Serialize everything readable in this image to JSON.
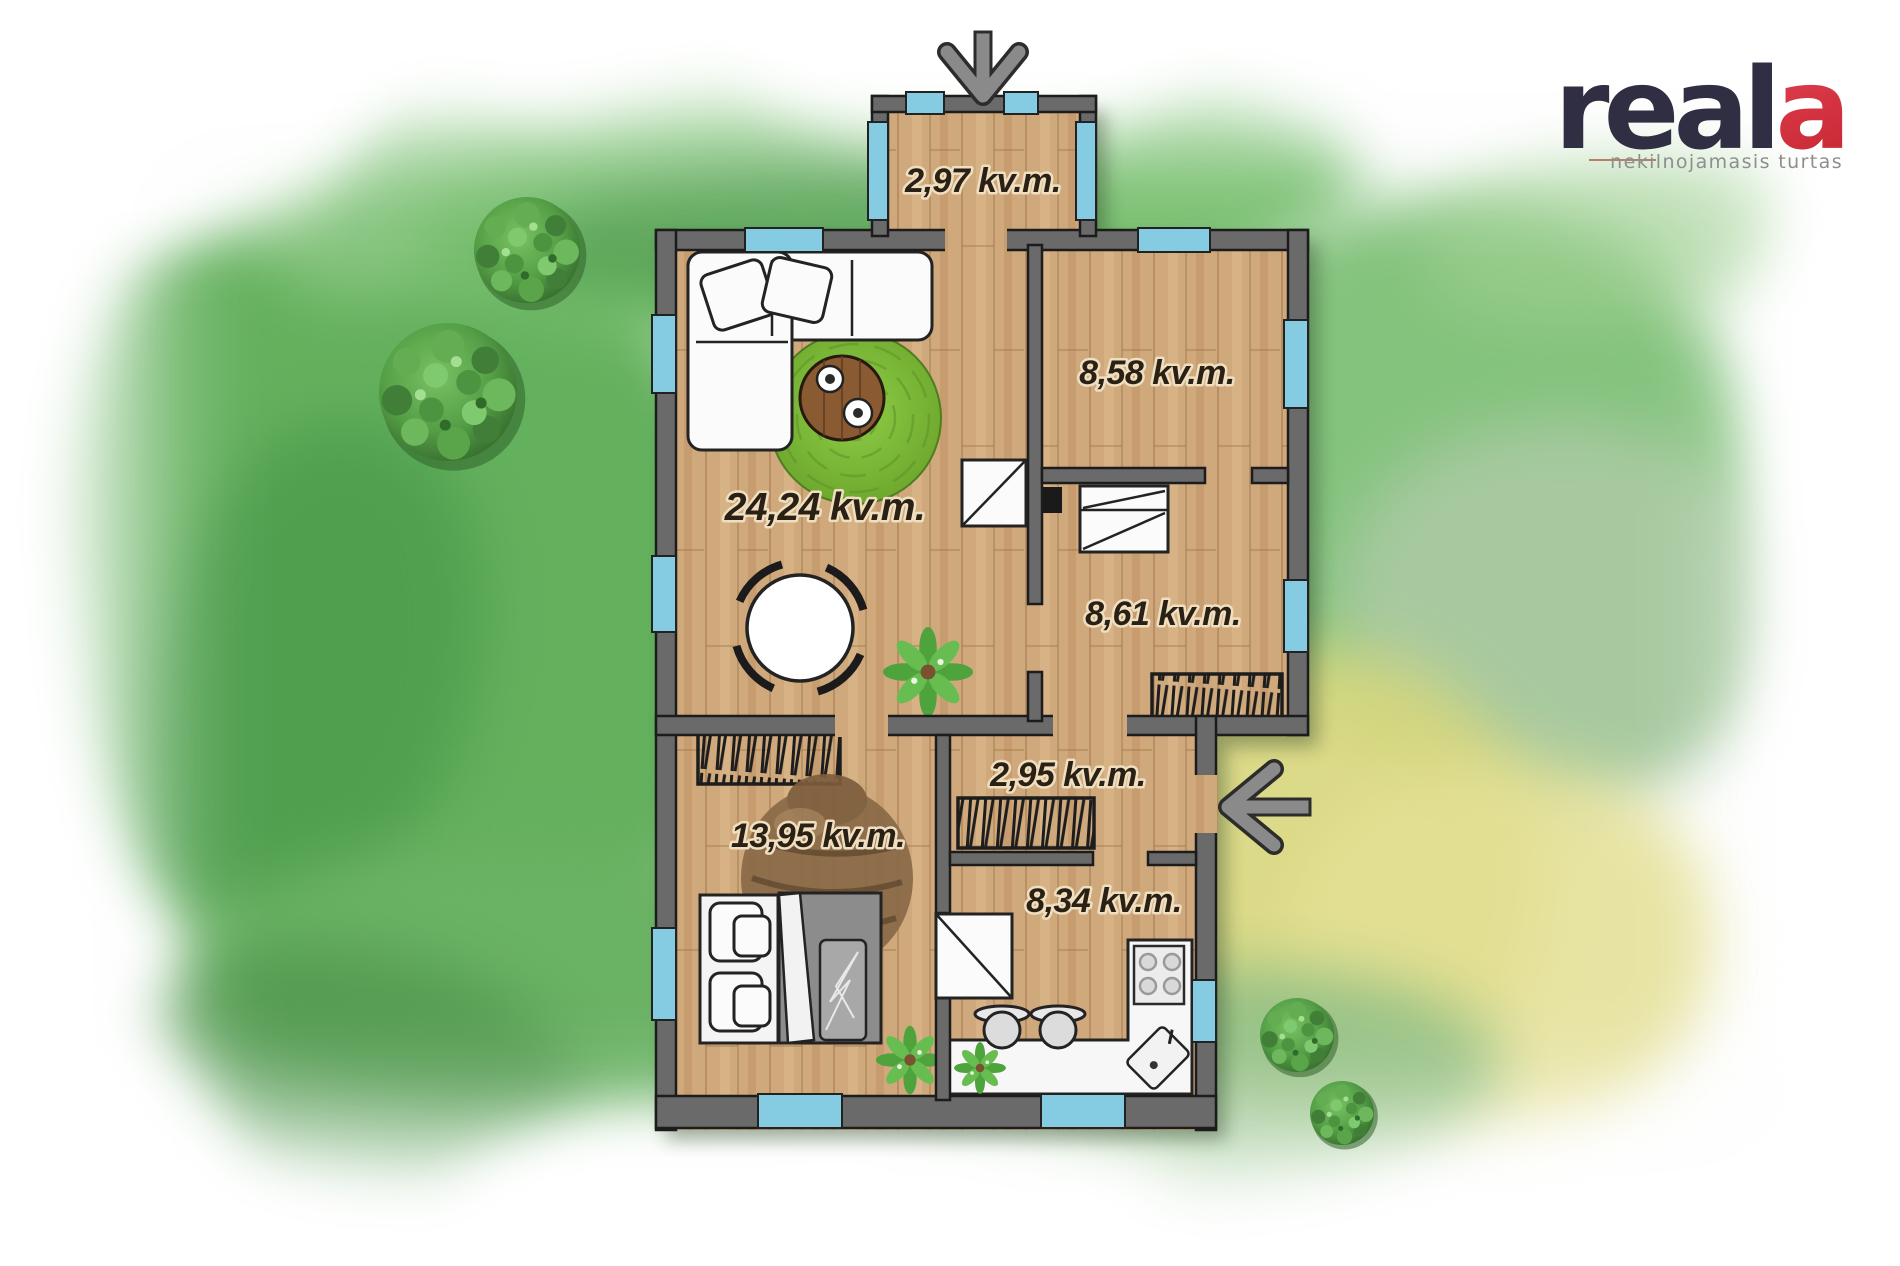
{
  "brand": {
    "name_prefix": "real",
    "name_accent": "a",
    "tagline": "nekilnojamasis turtas",
    "brand_color": "#302e42",
    "accent_gradient": [
      "#f2566b",
      "#c6242f"
    ]
  },
  "floor_plan": {
    "unit": "kv.m.",
    "rooms": [
      {
        "name": "entry-porch",
        "area_label": "2,97 kv.m."
      },
      {
        "name": "living-room",
        "area_label": "24,24 kv.m."
      },
      {
        "name": "room-top-right",
        "area_label": "8,58 kv.m."
      },
      {
        "name": "room-right",
        "area_label": "8,61 kv.m."
      },
      {
        "name": "hallway",
        "area_label": "2,95 kv.m."
      },
      {
        "name": "room-bottom-left",
        "area_label": "13,95 kv.m."
      },
      {
        "name": "kitchen",
        "area_label": "8,34 kv.m."
      }
    ],
    "icons": {
      "top_entrance": "arrow-down-icon",
      "side_entrance": "arrow-left-icon"
    },
    "colors": {
      "wall_fill": "#6a6a6a",
      "wall_outline": "#1c1c1c",
      "floor_wood": "#cfa87c",
      "window_blue": "#85cbe2",
      "rug_green": "#79b838",
      "label_text": "#2a2014",
      "arrow_gray": "#8a8a8a",
      "garden_green": "#63b05d",
      "garden_yellow": "#d8d77c"
    }
  }
}
